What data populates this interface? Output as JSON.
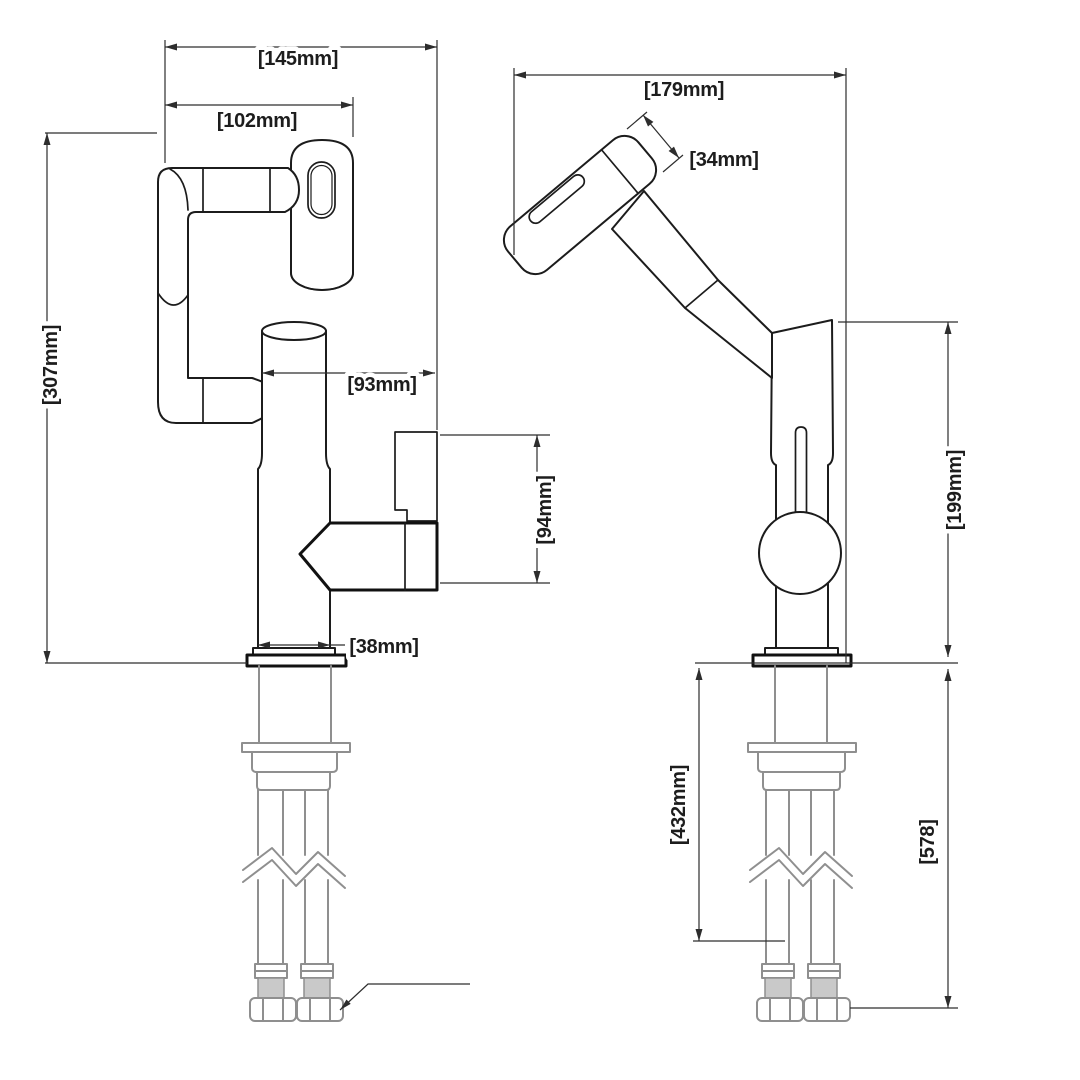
{
  "drawing": {
    "type": "faucet-installation-technical-drawing",
    "background": "#ffffff",
    "line_color": "#1c1c1c",
    "hardware_line_color": "#8f8f8f",
    "views": [
      "front-view-spout-folded",
      "side-view-spout-raised"
    ]
  },
  "dims": {
    "front_overall_width": "[145mm]",
    "front_spout_width": "[102mm]",
    "front_overall_height": "[307mm]",
    "front_body_to_handle": "[93mm]",
    "front_handle_height": "[94mm]",
    "front_base_diameter": "[38mm]",
    "side_overall_reach": "[179mm]",
    "side_head_width": "[34mm]",
    "side_height_above_counter": "[199mm]",
    "side_hose_length": "[432mm]",
    "side_total_below_length": "[578]"
  }
}
